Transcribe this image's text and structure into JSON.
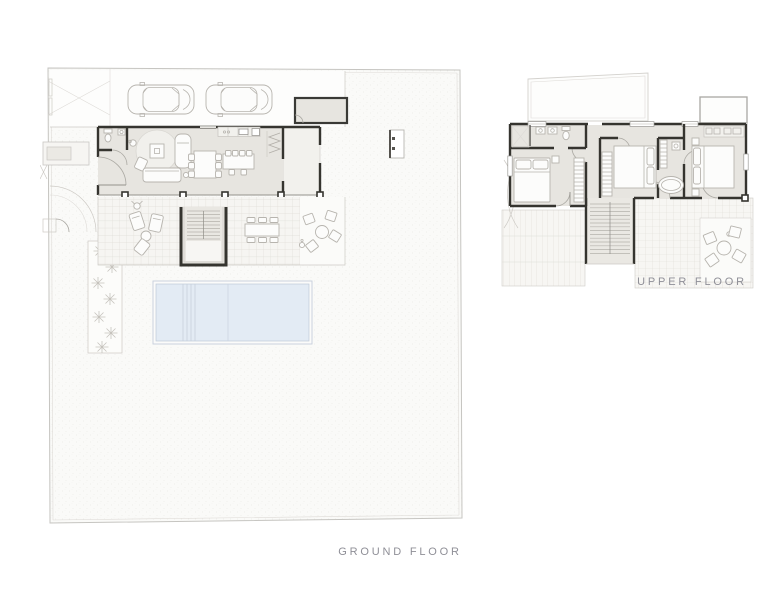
{
  "page": {
    "background": "#ffffff"
  },
  "plans": {
    "ground": {
      "label": "GROUND FLOOR",
      "features": [
        "entrance-gate",
        "driveway",
        "car",
        "car",
        "wc",
        "living-room",
        "kitchen",
        "dining",
        "island",
        "porch",
        "terrace",
        "exterior-stairs",
        "outdoor-dining",
        "outdoor-lounge",
        "outdoor-seating",
        "palm-garden",
        "swimming-pool",
        "garden-structure"
      ]
    },
    "upper": {
      "label": "UPPER FLOOR",
      "features": [
        "roof-outline",
        "bathroom",
        "bedroom",
        "bedroom",
        "bedroom",
        "bathtub",
        "wardrobe",
        "staircase",
        "slatted-terrace",
        "roof-terrace",
        "outdoor-seating"
      ]
    }
  },
  "colors": {
    "wall": "#35342f",
    "interior_fill": "#e7e5e0",
    "furniture_stroke": "#b7b4ae",
    "pool_water": "#e3ebf4",
    "pool_edge": "#bfcad7",
    "site_outline": "#c6c5c1",
    "label_text": "#8f8f97"
  }
}
